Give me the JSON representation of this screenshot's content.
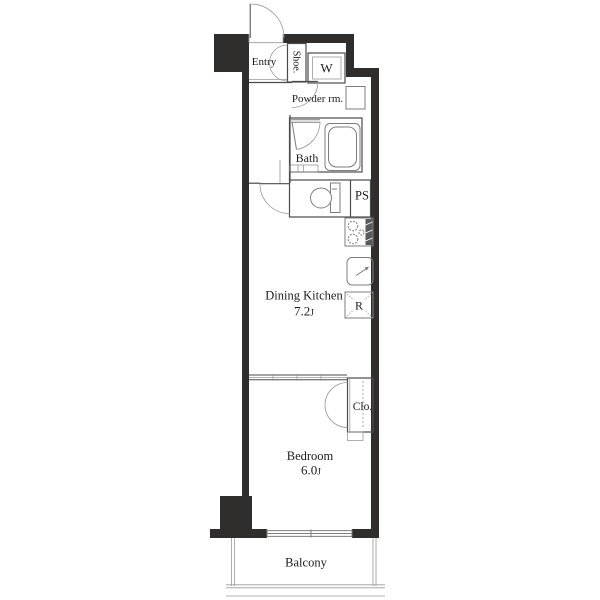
{
  "floorplan": {
    "type": "apartment-floorplan",
    "rooms": {
      "entry": {
        "label": "Entry"
      },
      "shoe_cabinet": {
        "label": "Shoe."
      },
      "washer_space": {
        "label": "W"
      },
      "powder_room": {
        "label": "Powder rm."
      },
      "bath": {
        "label": "Bath"
      },
      "pipe_space": {
        "label": "PS"
      },
      "dining_kitchen": {
        "label": "Dining Kitchen",
        "size": "7.2",
        "size_unit": "J"
      },
      "refrigerator_space": {
        "label": "R"
      },
      "closet": {
        "label": "Clo."
      },
      "bedroom": {
        "label": "Bedroom",
        "size": "6.0",
        "size_unit": "J"
      },
      "balcony": {
        "label": "Balcony"
      }
    },
    "colors": {
      "wall": "#2f2e2d",
      "line": "#4b4b4b",
      "fixture": "#7d7d7d",
      "lite": "#9a9a9a",
      "text": "#1c1c1c",
      "background": "#ffffff"
    }
  }
}
